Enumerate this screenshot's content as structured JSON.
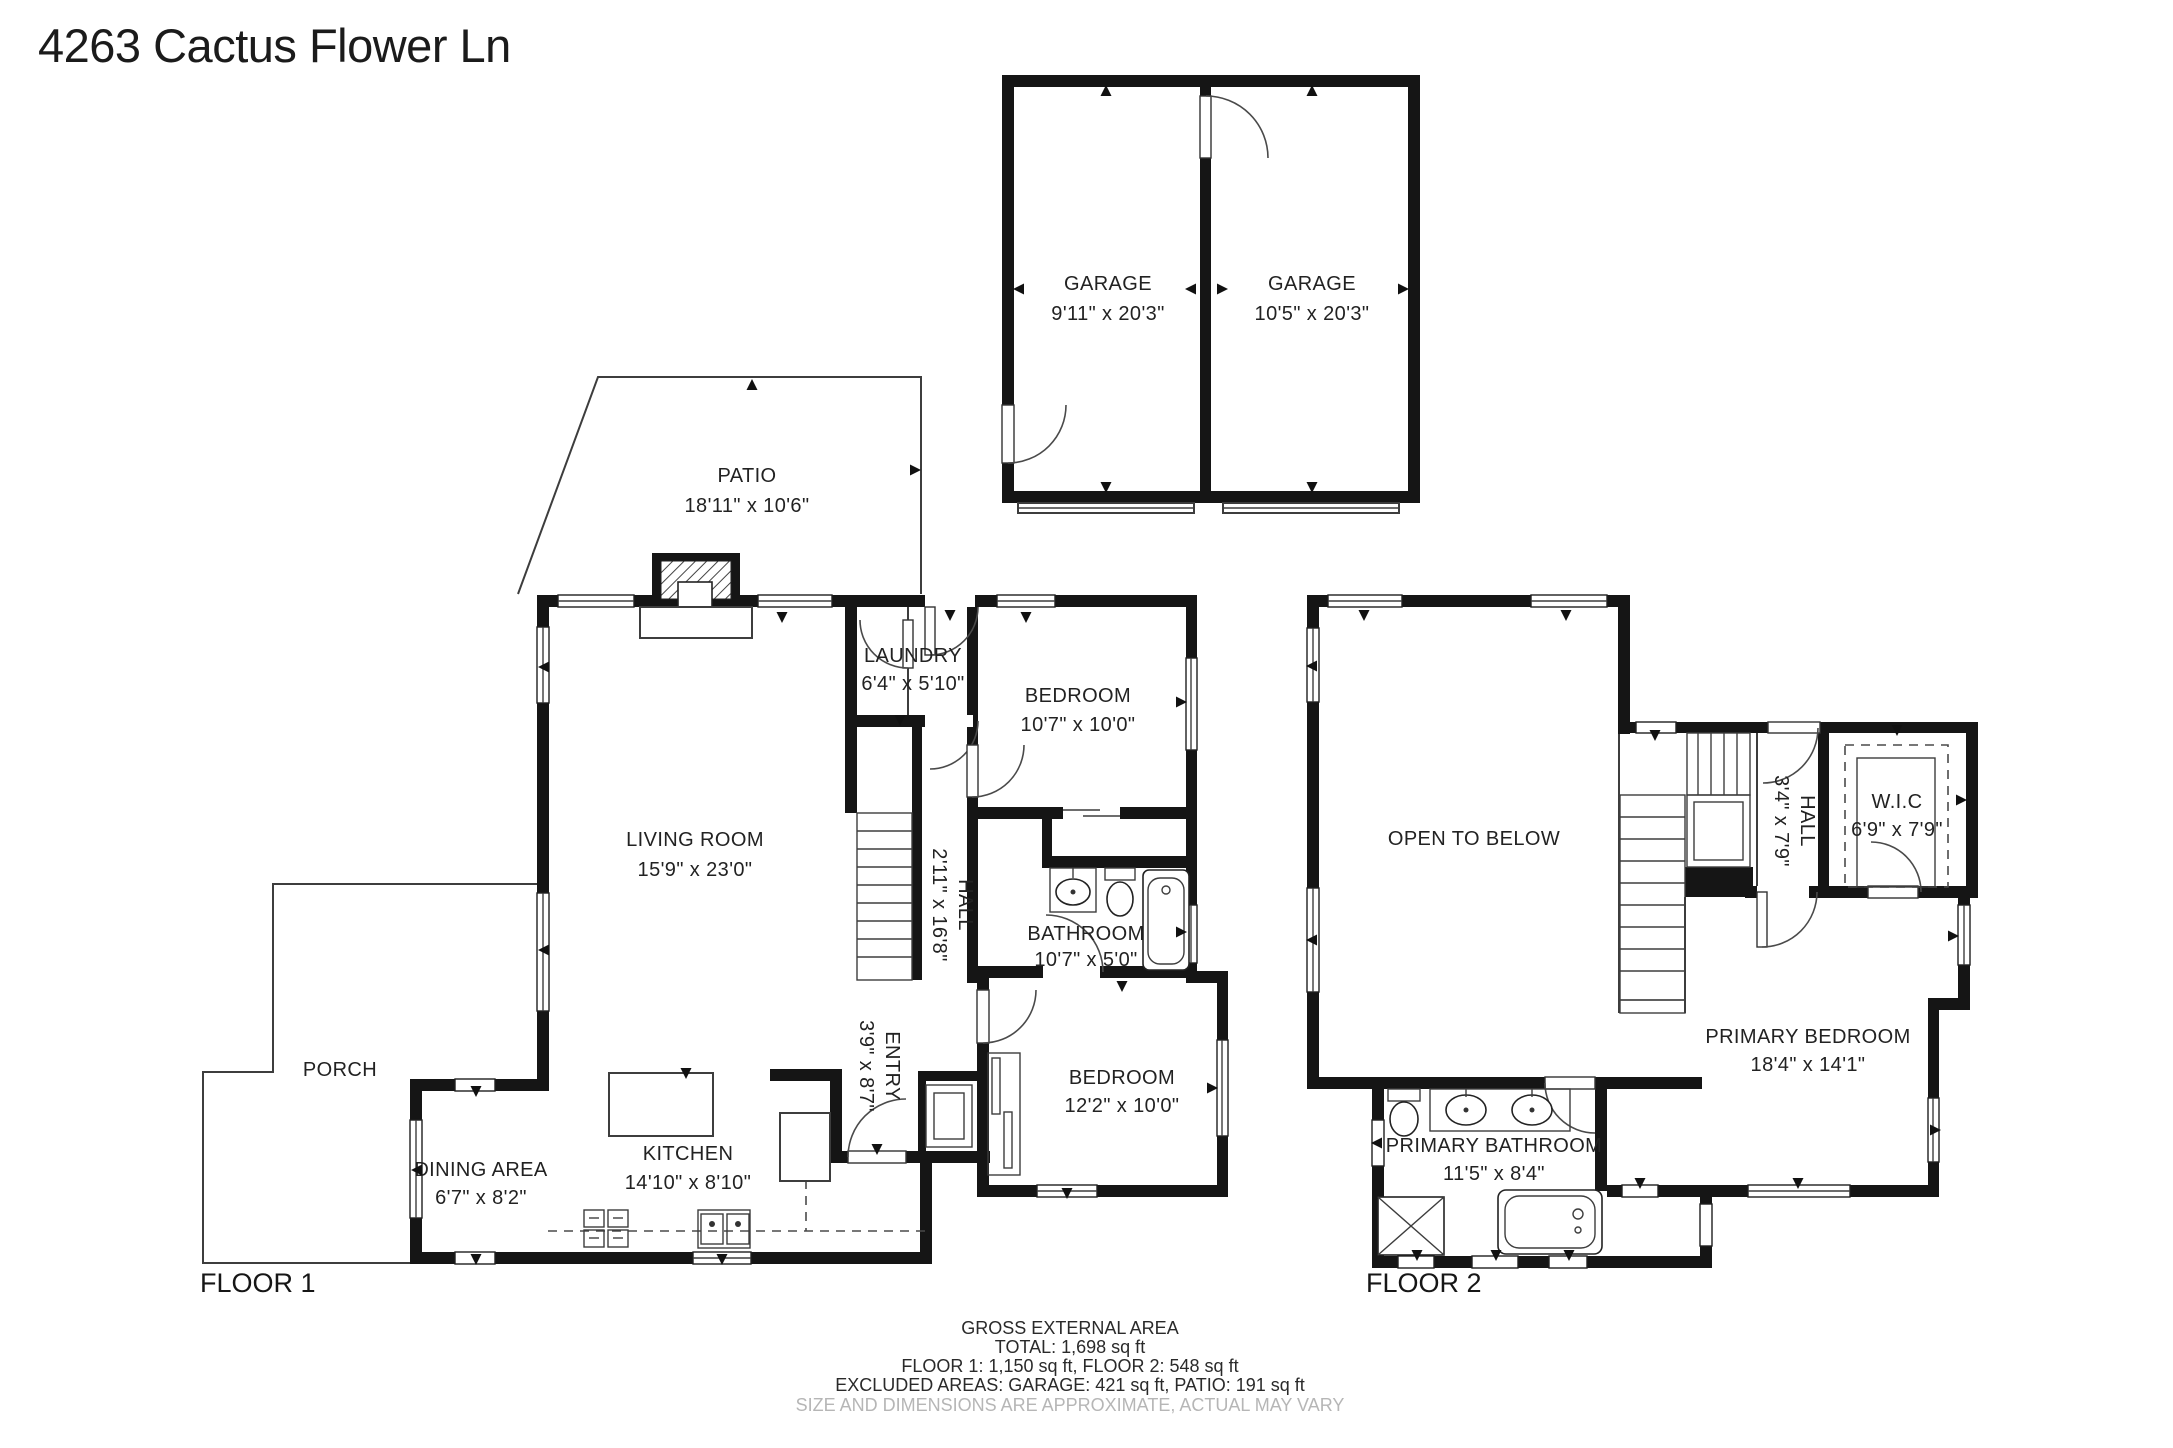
{
  "title": "4263 Cactus Flower Ln",
  "garage": {
    "bay_left": {
      "name": "GARAGE",
      "dims": "9'11\" x 20'3\""
    },
    "bay_right": {
      "name": "GARAGE",
      "dims": "10'5\" x 20'3\""
    }
  },
  "outdoor": {
    "patio": {
      "name": "PATIO",
      "dims": "18'11\" x 10'6\""
    },
    "porch": {
      "name": "PORCH"
    }
  },
  "floor1": {
    "label": "FLOOR 1",
    "living_room": {
      "name": "LIVING ROOM",
      "dims": "15'9\" x 23'0\""
    },
    "laundry": {
      "name": "LAUNDRY",
      "dims": "6'4\" x 5'10\""
    },
    "bedroom_top": {
      "name": "BEDROOM",
      "dims": "10'7\" x 10'0\""
    },
    "hall": {
      "name": "HALL",
      "dims": "2'11\" x 16'8\""
    },
    "bathroom": {
      "name": "BATHROOM",
      "dims": "10'7\" x 5'0\""
    },
    "bedroom_bottom": {
      "name": "BEDROOM",
      "dims": "12'2\" x 10'0\""
    },
    "entry": {
      "name": "ENTRY",
      "dims": "3'9\" x 8'7\""
    },
    "dining_area": {
      "name": "DINING AREA",
      "dims": "6'7\" x 8'2\""
    },
    "kitchen": {
      "name": "KITCHEN",
      "dims": "14'10\" x 8'10\""
    }
  },
  "floor2": {
    "label": "FLOOR 2",
    "open_to_below": {
      "name": "OPEN TO BELOW"
    },
    "hall": {
      "name": "HALL",
      "dims": "3'4\" x 7'9\""
    },
    "wic": {
      "name": "W.I.C",
      "dims": "6'9\" x 7'9\""
    },
    "primary_bedroom": {
      "name": "PRIMARY BEDROOM",
      "dims": "18'4\" x 14'1\""
    },
    "primary_bathroom": {
      "name": "PRIMARY BATHROOM",
      "dims": "11'5\" x 8'4\""
    }
  },
  "footer": {
    "line1": "GROSS EXTERNAL AREA",
    "line2": "TOTAL: 1,698 sq ft",
    "line3": "FLOOR 1: 1,150 sq ft, FLOOR 2: 548 sq ft",
    "line4": "EXCLUDED AREAS: GARAGE: 421 sq ft, PATIO: 191 sq ft",
    "disclaimer": "SIZE AND DIMENSIONS ARE APPROXIMATE, ACTUAL MAY VARY"
  },
  "colors": {
    "wall": "#151515",
    "line": "#3d3d3d",
    "text": "#222222",
    "muted": "#b6b6b6"
  }
}
